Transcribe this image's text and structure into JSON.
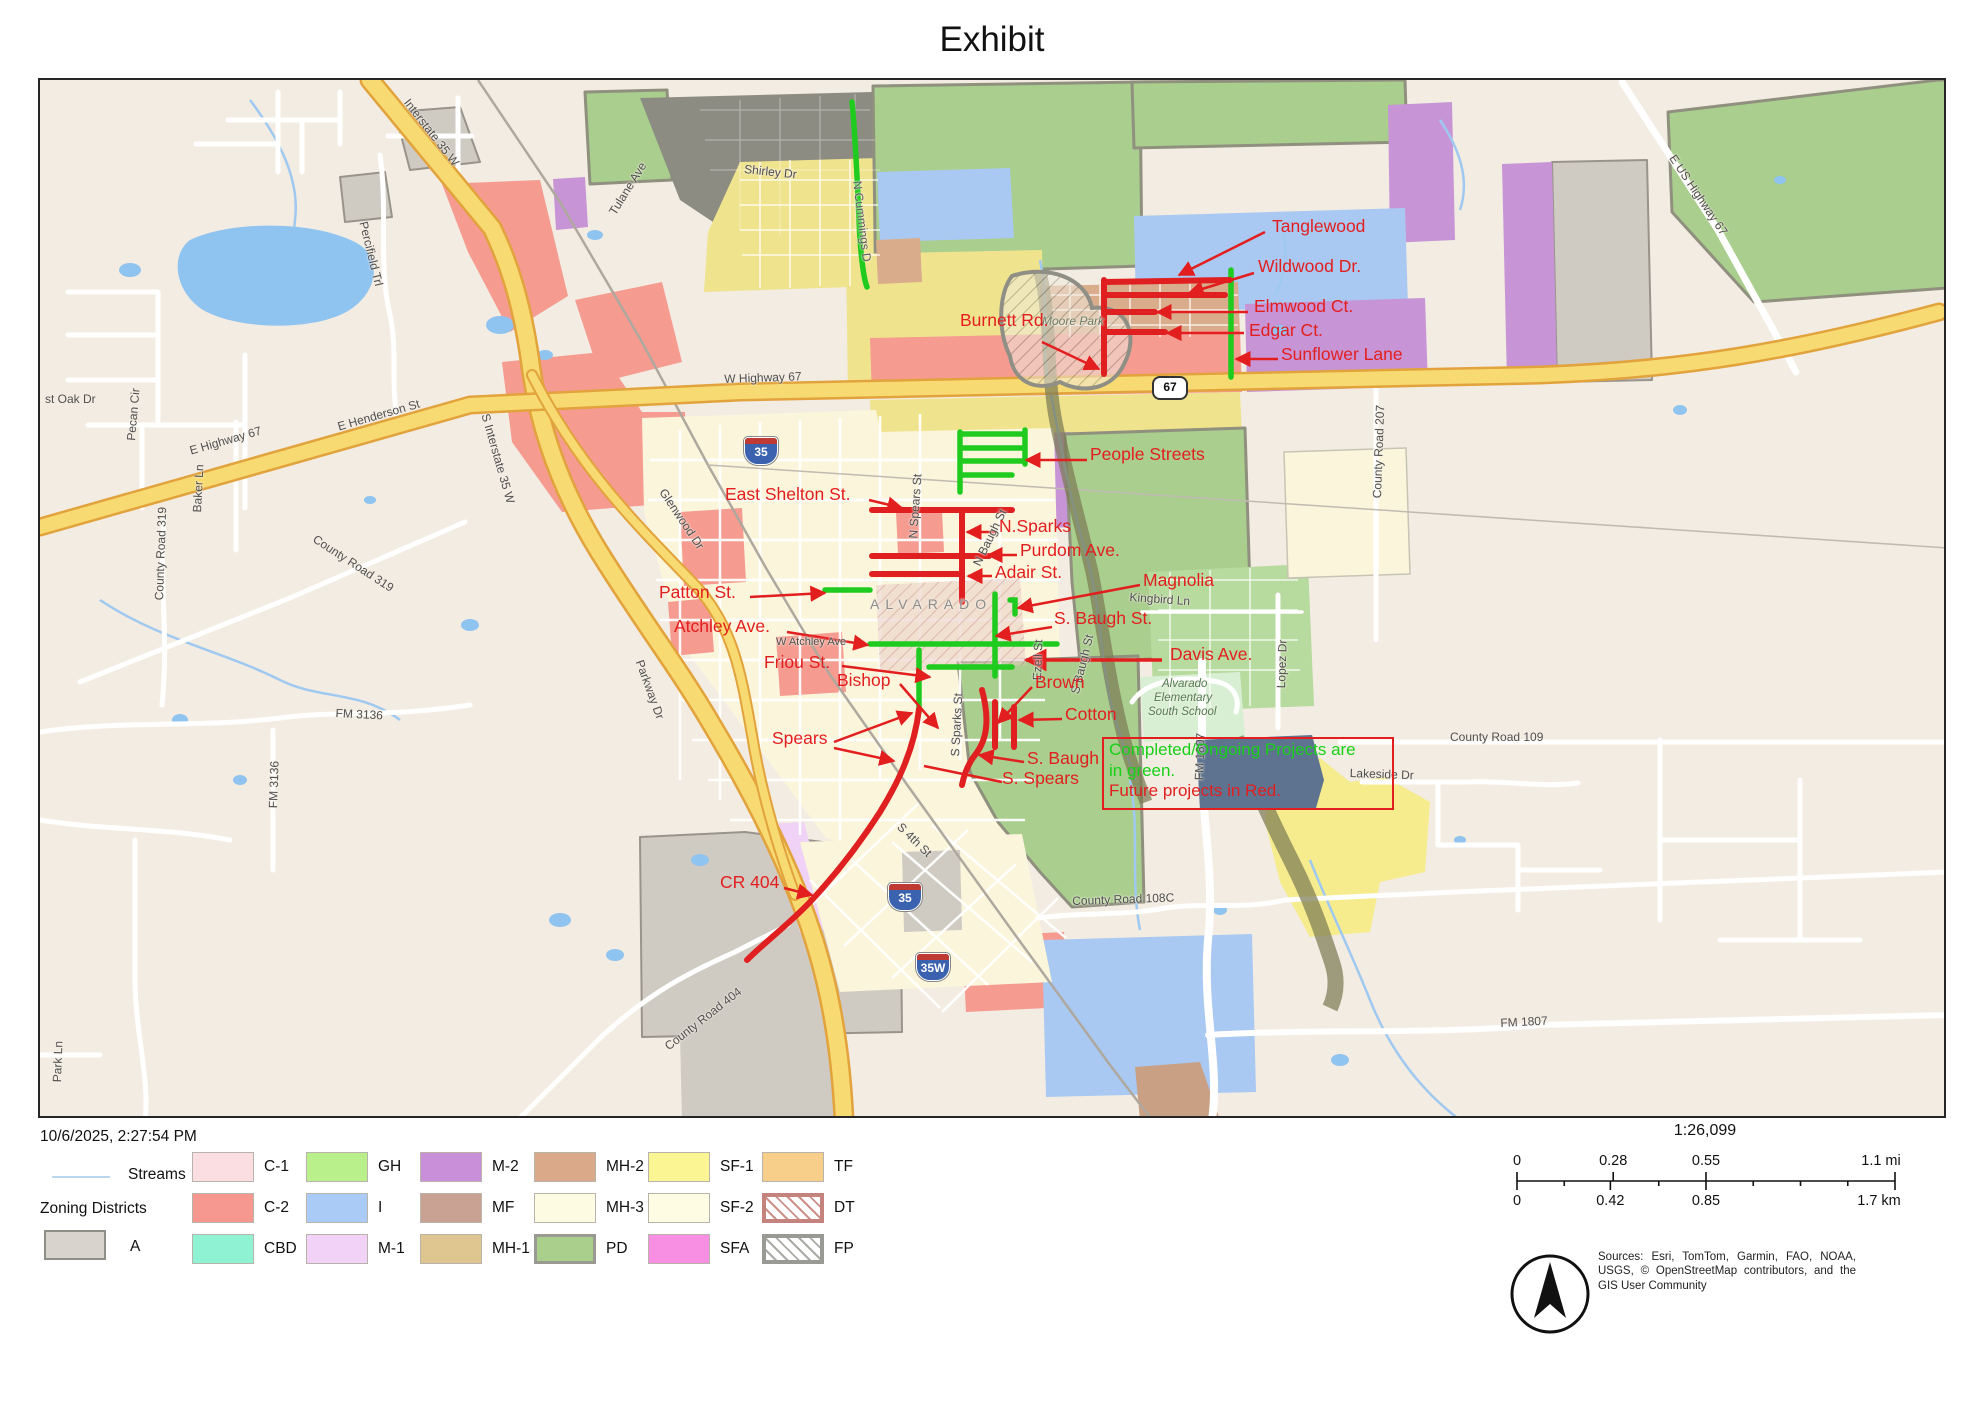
{
  "title": "Exhibit",
  "city_label": "ALVARADO",
  "note": {
    "line1": "Completed/Ongoing Projects are",
    "line2": "in green.",
    "line3": "Future projects in Red."
  },
  "accent": {
    "project_red": "#E31E1E",
    "project_green": "#17D117"
  },
  "shields": [
    {
      "t": "35",
      "x": 704,
      "y": 357,
      "type": "i"
    },
    {
      "t": "35",
      "x": 848,
      "y": 803,
      "type": "i"
    },
    {
      "t": "35W",
      "x": 876,
      "y": 873,
      "type": "i"
    },
    {
      "t": "67",
      "x": 1112,
      "y": 296,
      "type": "us"
    }
  ],
  "street_labels": [
    {
      "t": "Shirley Dr",
      "x": 705,
      "y": 82,
      "r": 6
    },
    {
      "t": "Tulane Ave",
      "x": 566,
      "y": 130,
      "r": -58
    },
    {
      "t": "N Cummings D",
      "x": 824,
      "y": 100,
      "r": 83,
      "c": "#5b5b5b"
    },
    {
      "t": "Percifield Trl",
      "x": 330,
      "y": 140,
      "r": 76
    },
    {
      "t": "Interstate 35 W",
      "x": 372,
      "y": 16,
      "r": 52
    },
    {
      "t": "E US Highway 67",
      "x": 1638,
      "y": 72,
      "r": 56
    },
    {
      "t": "Pecan Cir",
      "x": 84,
      "y": 360,
      "r": -85
    },
    {
      "t": "st Oak Dr",
      "x": 5,
      "y": 312,
      "r": 0
    },
    {
      "t": "Baker Ln",
      "x": 150,
      "y": 432,
      "r": -87
    },
    {
      "t": "E Highway 67",
      "x": 148,
      "y": 364,
      "r": -16
    },
    {
      "t": "E Henderson St",
      "x": 296,
      "y": 340,
      "r": -16
    },
    {
      "t": "County Road 319",
      "x": 278,
      "y": 452,
      "r": 33
    },
    {
      "t": "County Road 319",
      "x": 112,
      "y": 520,
      "r": -88
    },
    {
      "t": "W Highway 67",
      "x": 684,
      "y": 292,
      "r": -2
    },
    {
      "t": "Glenwood Dr",
      "x": 628,
      "y": 406,
      "r": 56
    },
    {
      "t": "S Interstate 35 W",
      "x": 452,
      "y": 332,
      "r": 74
    },
    {
      "t": "N Spears St",
      "x": 866,
      "y": 458,
      "r": -86
    },
    {
      "t": "N Baugh St",
      "x": 930,
      "y": 482,
      "r": -64
    },
    {
      "t": "ALVARADO",
      "x": 830,
      "y": 516,
      "r": 0,
      "sp": 6,
      "c": "#8c8c8c",
      "s": 14
    },
    {
      "t": "W Atchley Ave",
      "x": 736,
      "y": 556,
      "r": 0,
      "s": 11
    },
    {
      "t": "Parkway Dr",
      "x": 606,
      "y": 578,
      "r": 70
    },
    {
      "t": "S Sparks St",
      "x": 908,
      "y": 676,
      "r": -87
    },
    {
      "t": "Ezell St",
      "x": 990,
      "y": 600,
      "r": -88
    },
    {
      "t": "S Baugh St",
      "x": 1028,
      "y": 612,
      "r": -76
    },
    {
      "t": "Kingbird Ln",
      "x": 1090,
      "y": 510,
      "r": 4
    },
    {
      "t": "Lopez Dr",
      "x": 1234,
      "y": 608,
      "r": -88
    },
    {
      "t": "Moore Park",
      "x": 1002,
      "y": 234,
      "r": 0,
      "i": 1,
      "c": "#6b7a5d"
    },
    {
      "t": "Alvarado",
      "x": 1122,
      "y": 598,
      "i": 1,
      "c": "#4e7d52",
      "s": 11.5
    },
    {
      "t": "Elementary",
      "x": 1114,
      "y": 612,
      "i": 1,
      "c": "#4e7d52",
      "s": 11.5
    },
    {
      "t": "South School",
      "x": 1108,
      "y": 626,
      "i": 1,
      "c": "#4e7d52",
      "s": 11.5
    },
    {
      "t": "FM 1807",
      "x": 1152,
      "y": 700,
      "r": -88
    },
    {
      "t": "Lakeside Dr",
      "x": 1310,
      "y": 686,
      "r": 2
    },
    {
      "t": "County Road 109",
      "x": 1410,
      "y": 650,
      "r": 0
    },
    {
      "t": "County Road 108C",
      "x": 1032,
      "y": 814,
      "r": -2
    },
    {
      "t": "County Road 404",
      "x": 622,
      "y": 962,
      "r": -38
    },
    {
      "t": "FM 3136",
      "x": 296,
      "y": 626,
      "r": 3
    },
    {
      "t": "FM 3136",
      "x": 226,
      "y": 728,
      "r": -88
    },
    {
      "t": "S 4th St",
      "x": 864,
      "y": 740,
      "r": 44
    },
    {
      "t": "County Road 207",
      "x": 1330,
      "y": 418,
      "r": -88
    },
    {
      "t": "FM 1807",
      "x": 1460,
      "y": 936,
      "r": -3
    },
    {
      "t": "Park Ln",
      "x": 10,
      "y": 1002,
      "r": -88
    }
  ],
  "project_labels": [
    {
      "t": "Tanglewood",
      "x": 1232,
      "y": 136
    },
    {
      "t": "Wildwood Dr.",
      "x": 1218,
      "y": 176
    },
    {
      "t": "Elmwood Ct.",
      "x": 1214,
      "y": 216
    },
    {
      "t": "Edgar Ct.",
      "x": 1209,
      "y": 240
    },
    {
      "t": "Sunflower Lane",
      "x": 1241,
      "y": 264
    },
    {
      "t": "Burnett Rd.",
      "x": 920,
      "y": 230
    },
    {
      "t": "People Streets",
      "x": 1050,
      "y": 364
    },
    {
      "t": "East Shelton St.",
      "x": 685,
      "y": 404
    },
    {
      "t": "N.Sparks",
      "x": 959,
      "y": 436
    },
    {
      "t": "Purdom Ave.",
      "x": 980,
      "y": 460
    },
    {
      "t": "Adair St.",
      "x": 955,
      "y": 482
    },
    {
      "t": "Magnolia",
      "x": 1103,
      "y": 490
    },
    {
      "t": "Patton St.",
      "x": 619,
      "y": 502
    },
    {
      "t": "S. Baugh St.",
      "x": 1014,
      "y": 528
    },
    {
      "t": "Atchley Ave.",
      "x": 634,
      "y": 536
    },
    {
      "t": "Davis Ave.",
      "x": 1130,
      "y": 564
    },
    {
      "t": "Friou St.",
      "x": 724,
      "y": 572
    },
    {
      "t": "Bishop",
      "x": 797,
      "y": 590
    },
    {
      "t": "Brown",
      "x": 995,
      "y": 592
    },
    {
      "t": "Cotton",
      "x": 1025,
      "y": 624
    },
    {
      "t": "Spears",
      "x": 732,
      "y": 648
    },
    {
      "t": "S. Baugh",
      "x": 987,
      "y": 668
    },
    {
      "t": "S. Spears",
      "x": 962,
      "y": 688
    },
    {
      "t": "CR 404",
      "x": 680,
      "y": 792
    }
  ],
  "legend": {
    "timestamp": "10/6/2025, 2:27:54 PM",
    "streams_label": "Streams",
    "zoning_title": "Zoning Districts",
    "a_item": {
      "code": "A",
      "fill": "#D8D4CD",
      "border": "#8F8F88",
      "bw": 2
    },
    "items": [
      {
        "code": "C-1",
        "col": 0,
        "row": 0,
        "fill": "#FBDEE1"
      },
      {
        "code": "C-2",
        "col": 0,
        "row": 1,
        "fill": "#F79890"
      },
      {
        "code": "CBD",
        "col": 0,
        "row": 2,
        "fill": "#8FF2D2"
      },
      {
        "code": "GH",
        "col": 1,
        "row": 0,
        "fill": "#B9F08B"
      },
      {
        "code": "I",
        "col": 1,
        "row": 1,
        "fill": "#AACBF5"
      },
      {
        "code": "M-1",
        "col": 1,
        "row": 2,
        "fill": "#F2D3F7"
      },
      {
        "code": "M-2",
        "col": 2,
        "row": 0,
        "fill": "#C98FD9"
      },
      {
        "code": "MF",
        "col": 2,
        "row": 1,
        "fill": "#C9A294"
      },
      {
        "code": "MH-1",
        "col": 2,
        "row": 2,
        "fill": "#DFC691"
      },
      {
        "code": "MH-2",
        "col": 3,
        "row": 0,
        "fill": "#D9A98A"
      },
      {
        "code": "MH-3",
        "col": 3,
        "row": 1,
        "fill": "#FEFBE3"
      },
      {
        "code": "PD",
        "col": 3,
        "row": 2,
        "fill": "#AACF8C",
        "border": "#9A9A92",
        "bw": 3
      },
      {
        "code": "SF-1",
        "col": 4,
        "row": 0,
        "fill": "#FBF593"
      },
      {
        "code": "SF-2",
        "col": 4,
        "row": 1,
        "fill": "#FEFCE3"
      },
      {
        "code": "SFA",
        "col": 4,
        "row": 2,
        "fill": "#F98FE3"
      },
      {
        "code": "TF",
        "col": 5,
        "row": 0,
        "fill": "#F8CE8B"
      },
      {
        "code": "DT",
        "col": 5,
        "row": 1,
        "fill": "#FFFFFF",
        "border": "#C4837C",
        "bw": 4,
        "hatch": "#CC9088"
      },
      {
        "code": "FP",
        "col": 5,
        "row": 2,
        "fill": "#FFFFFF",
        "border": "#9A9A94",
        "bw": 4,
        "hatch": "#AAAAA4"
      }
    ]
  },
  "scalebar": {
    "ratio": "1:26,099",
    "mi": [
      {
        "t": "0",
        "f": 0
      },
      {
        "t": "0.28",
        "f": 0.2545
      },
      {
        "t": "0.55",
        "f": 0.5
      },
      {
        "t": "1.1 mi",
        "f": 1
      }
    ],
    "km": [
      {
        "t": "0",
        "f": 0
      },
      {
        "t": "0.42",
        "f": 0.247
      },
      {
        "t": "0.85",
        "f": 0.5
      },
      {
        "t": "1.7 km",
        "f": 1
      }
    ]
  },
  "credits": "Sources: Esri, TomTom, Garmin, FAO, NOAA, USGS, © OpenStreetMap contributors, and the GIS User Community"
}
